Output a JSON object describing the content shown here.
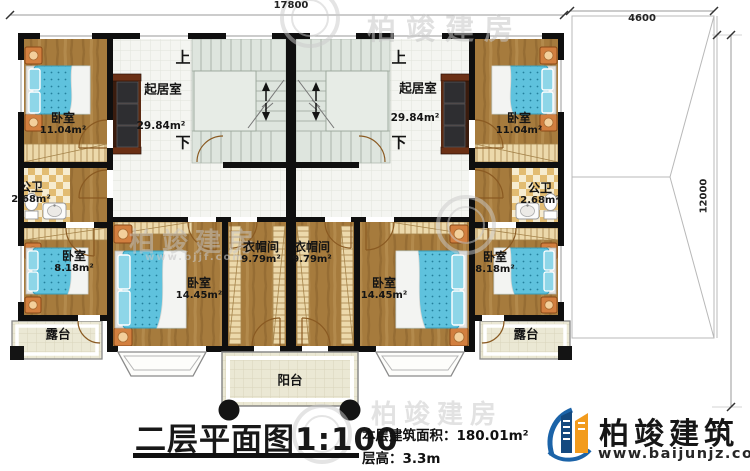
{
  "dimensions": {
    "top_width": "17800",
    "side_top": "4600",
    "side_height": "12000"
  },
  "rooms": {
    "bedroom": "卧室",
    "bedroom_area_a": "11.04m²",
    "bedroom_area_b": "8.18m²",
    "bedroom_area_c": "14.45m²",
    "living": "起居室",
    "living_area": "29.84m²",
    "bath": "公卫",
    "bath_area": "2.68m²",
    "cloak": "衣帽间",
    "cloak_area": "9.79m²",
    "terrace": "露台",
    "balcony": "阳台",
    "stairs_up": "上",
    "stairs_down": "下"
  },
  "title": {
    "main": "二层平面图",
    "scale": "1:100",
    "area_label": "本层建筑面积：",
    "area_value": "180.01m²",
    "floor_height_label": "层高：",
    "floor_height_value": "3.3m"
  },
  "logo": {
    "name": "柏竣建筑",
    "url": "www.baijunjz.com"
  },
  "watermark": {
    "text": "柏竣建房",
    "url": "www.bjjf.com"
  },
  "colors": {
    "wall": "#0f0f0f",
    "wood_floor": "#a67b3d",
    "bed": "#5fc2dd",
    "brand_blue": "#1b63a8",
    "brand_orange": "#f29b1d"
  }
}
